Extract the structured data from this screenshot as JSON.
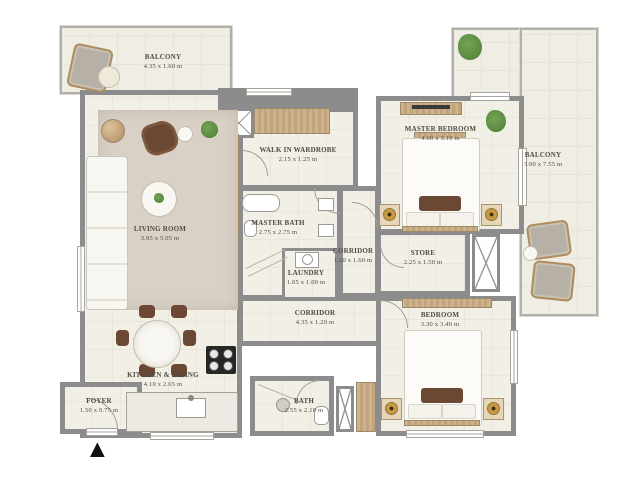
{
  "plan": {
    "rooms": {
      "balcony_top": {
        "name": "BALCONY",
        "dims": "4.35 x 1.60 m"
      },
      "living": {
        "name": "LIVING ROOM",
        "dims": "3.95 x 5.05 m"
      },
      "wardrobe": {
        "name": "WALK IN WARDROBE",
        "dims": "2.15 x 1.25 m"
      },
      "master_bedroom": {
        "name": "MASTER BEDROOM",
        "dims": "4.60 x 3.10 m"
      },
      "balcony_right": {
        "name": "BALCONY",
        "dims": "3.00 x 7.55 m"
      },
      "master_bath": {
        "name": "MASTER BATH",
        "dims": "2.75 x 2.75 m"
      },
      "corridor_upper": {
        "name": "CORRIDOR",
        "dims": "1.20 x 1.60 m"
      },
      "laundry": {
        "name": "LAUNDRY",
        "dims": "1.05 x 1.00 m"
      },
      "store": {
        "name": "STORE",
        "dims": "2.25 x 1.50 m"
      },
      "corridor_lower": {
        "name": "CORRIDOR",
        "dims": "4.35 x 1.20 m"
      },
      "bedroom": {
        "name": "BEDROOM",
        "dims": "3.30 x 3.40 m"
      },
      "kitchen": {
        "name": "KITCHEN & DINING",
        "dims": "4.10 x 2.65 m"
      },
      "foyer": {
        "name": "FOYER",
        "dims": "1.50 x 0.75 m"
      },
      "bath": {
        "name": "BATH",
        "dims": "2.55 x 2.10 m"
      }
    },
    "icons": {
      "north_arrow": "▲"
    },
    "colors": {
      "wall": "#8c8c8c",
      "floor": "#f2efe7",
      "balcony_floor": "#f0ede4",
      "wood": "#c6a87f",
      "rug": "#d9d1c6",
      "accent_brown": "#6b4833",
      "plant_green": "#4e7d3a",
      "lamp_gold": "#c99a3e",
      "fixture_white": "#ffffff",
      "north_black": "#111111"
    }
  }
}
